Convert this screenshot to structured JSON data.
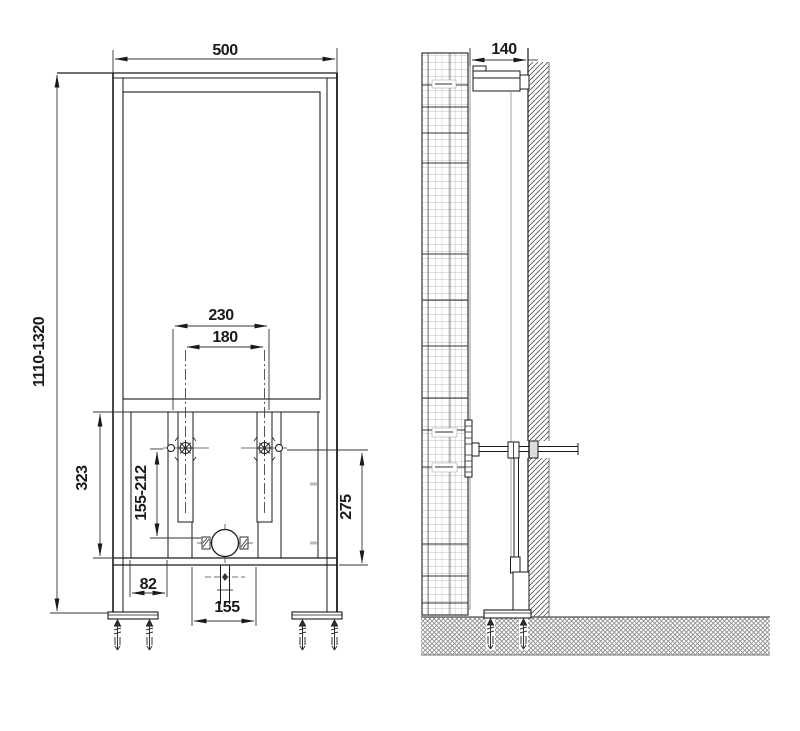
{
  "drawing": {
    "kind": "concealed installation frame - dimensioned technical drawing",
    "views": {
      "front": "front elevation",
      "side": "side section at wall"
    },
    "colors": {
      "line": "#1a1a1a",
      "dim_line": "#333333",
      "wall_hatch": "#555555",
      "floor_hatch": "#8a8a8a",
      "grid": "#aaaaaa",
      "background": "#ffffff"
    },
    "dims": {
      "front_width": "500",
      "front_height": "1110-1320",
      "top_span": "230",
      "rod_span": "180",
      "left_span": "323",
      "adjust_span": "155-212",
      "right_span": "275",
      "foot_offset": "82",
      "outlet_span": "155",
      "side_depth": "140"
    }
  }
}
